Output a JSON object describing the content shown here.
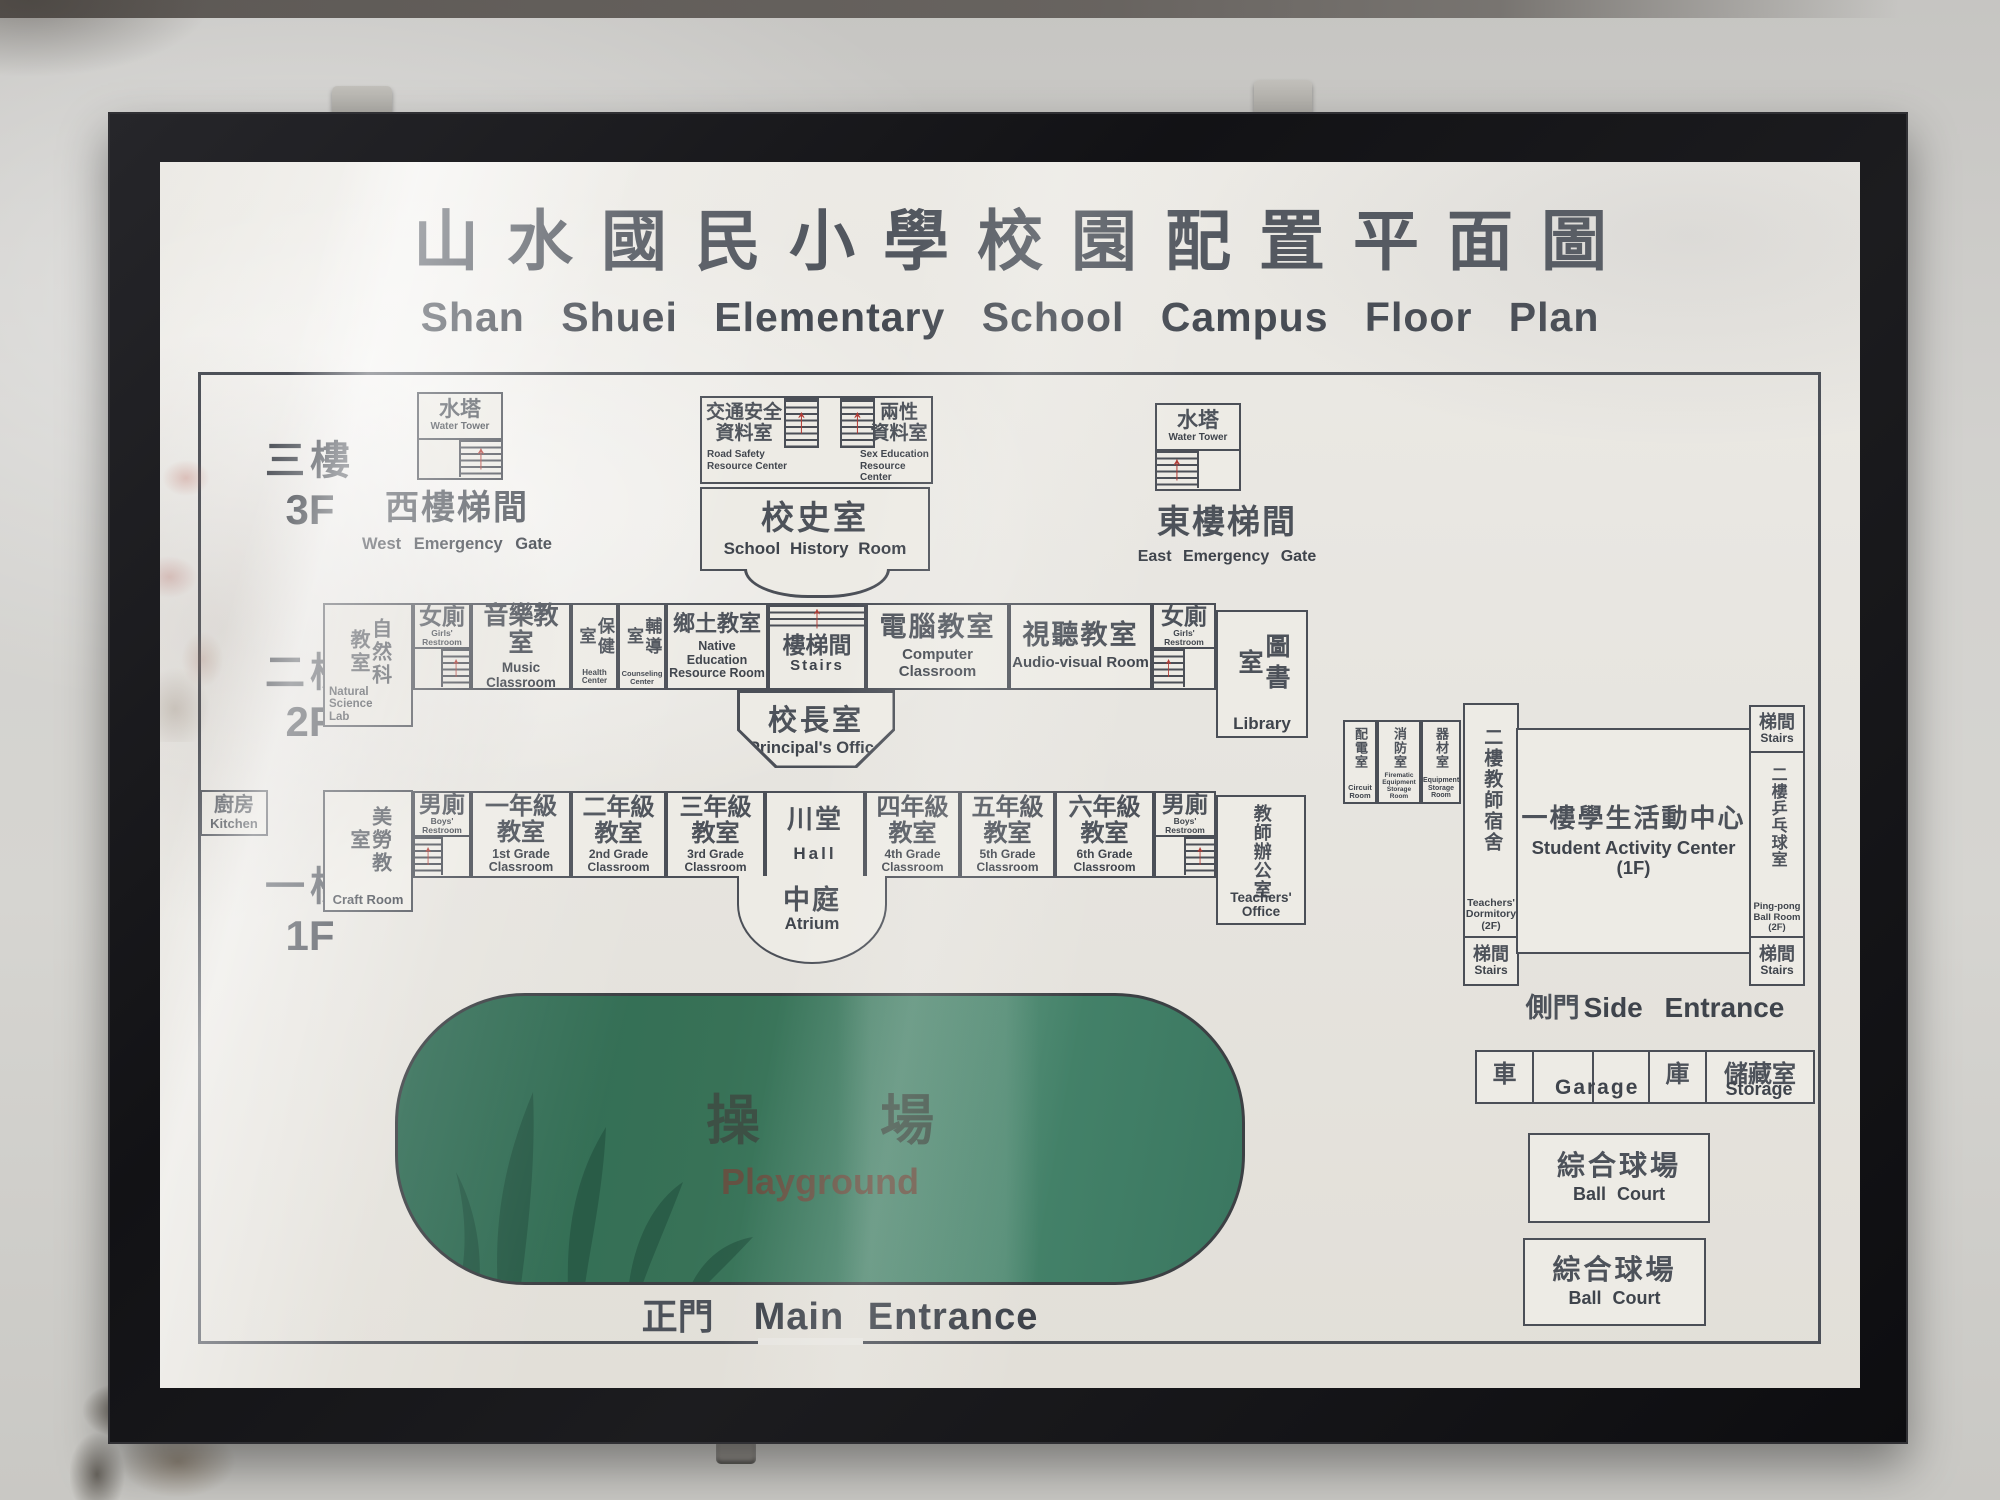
{
  "sign": {
    "title_zh": "山水國民小學校園配置平面圖",
    "title_en": "Shan Shuei Elementary School Campus Floor Plan",
    "floors": {
      "f3_zh": "三樓",
      "f3_en": "3F",
      "f2_zh": "二樓",
      "f2_en": "2F",
      "f1_zh": "一樓",
      "f1_en": "1F"
    },
    "f3": {
      "wt_zh": "水塔",
      "wt_en": "Water Tower",
      "west_gate_zh": "西樓梯間",
      "west_gate_en": "West Emergency Gate",
      "road_zh1": "交通安全",
      "road_zh2": "資料室",
      "road_en1": "Road Safety",
      "road_en2": "Resource Center",
      "sex_zh1": "兩性",
      "sex_zh2": "資料室",
      "sex_en1": "Sex Education",
      "sex_en2": "Resource Center",
      "history_zh": "校史室",
      "history_en": "School History Room",
      "east_gate_zh": "東樓梯間",
      "east_gate_en": "East Emergency Gate"
    },
    "f2": {
      "natsci_zh": "自然科教室",
      "natsci_en1": "Natural Science",
      "natsci_en2": "Lab",
      "girls_zh": "女廁",
      "girls_en": "Girls' Restroom",
      "music_zh": "音樂教室",
      "music_en": "Music Classroom",
      "health_zh": "保健室",
      "health_en": "Health Center",
      "counsel_zh": "輔導室",
      "counsel_en": "Counseling Center",
      "native_zh": "鄉土教室",
      "native_en1": "Native Education",
      "native_en2": "Resource Room",
      "stairs_zh": "樓梯間",
      "stairs_en": "Stairs",
      "computer_zh": "電腦教室",
      "computer_en": "Computer Classroom",
      "av_zh": "視聽教室",
      "av_en": "Audio-visual Room",
      "library_zh": "圖書室",
      "library_en": "Library",
      "principal_zh": "校長室",
      "principal_en": "Principal's Office"
    },
    "f1": {
      "kitchen_zh": "廚房",
      "kitchen_en": "Kitchen",
      "craft_zh": "美勞教室",
      "craft_en": "Craft Room",
      "boys_zh": "男廁",
      "boys_en": "Boys' Restroom",
      "classroom_zh": "教室",
      "grades": [
        {
          "zh": "一年級",
          "en": "1st Grade Classroom"
        },
        {
          "zh": "二年級",
          "en": "2nd Grade Classroom"
        },
        {
          "zh": "三年級",
          "en": "3rd Grade Classroom"
        },
        {
          "zh": "四年級",
          "en": "4th Grade Classroom"
        },
        {
          "zh": "五年級",
          "en": "5th Grade Classroom"
        },
        {
          "zh": "六年級",
          "en": "6th Grade Classroom"
        }
      ],
      "hall_zh": "川堂",
      "hall_en": "Hall",
      "toffice_zh": "教師辦公室",
      "toffice_en": "Teachers' Office",
      "atrium_zh": "中庭",
      "atrium_en": "Atrium"
    },
    "east_wing": {
      "circuit_zh": "配電室",
      "circuit_en1": "Circuit",
      "circuit_en2": "Room",
      "fire_zh": "消防室",
      "fire_en1": "Firematic",
      "fire_en2": "Equipment",
      "fire_en3": "Storage Room",
      "equip_zh": "器材室",
      "equip_en1": "Equipment",
      "equip_en2": "Storage",
      "equip_en3": "Room",
      "dorm_zh": "二樓教師宿舍",
      "dorm_en1": "Teachers'",
      "dorm_en2": "Dormitory",
      "dorm_en3": "(2F)",
      "activity_zh": "一樓學生活動中心",
      "activity_en": "Student Activity Center (1F)",
      "stairs_zh": "梯間",
      "stairs_en": "Stairs",
      "pingpong_zh": "二樓乒乓球室",
      "pingpong_en1": "Ping-pong",
      "pingpong_en2": "Ball Room",
      "pingpong_en3": "(2F)",
      "side_zh": "側門",
      "side_en": "Side Entrance"
    },
    "outdoor": {
      "playground_zh": "操場",
      "playground_en": "Playground",
      "main_zh": "正門",
      "main_en": "Main Entrance",
      "car_zh": "車",
      "ku_zh": "庫",
      "garage_en": "Garage",
      "storage_zh": "儲藏室",
      "storage_en": "Storage",
      "court_zh": "綜合球場",
      "court_en": "Ball Court"
    }
  }
}
